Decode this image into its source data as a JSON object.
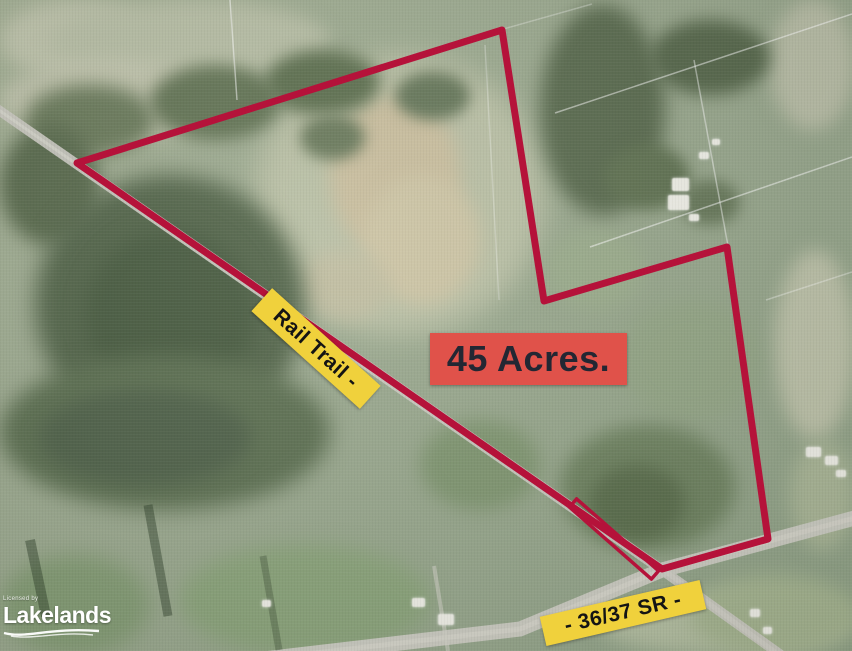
{
  "map": {
    "labels": {
      "acreage": "45 Acres.",
      "rail_trail": "Rail Trail -",
      "road": "- 36/37 SR -"
    },
    "watermark": {
      "prefix": "Licensed by",
      "brand": "Lakelands"
    },
    "colors": {
      "boundary": "#b5123a",
      "label-yellow": "#f0d13c",
      "label-red": "#e0524a",
      "label-text-dark": "#232733"
    }
  }
}
